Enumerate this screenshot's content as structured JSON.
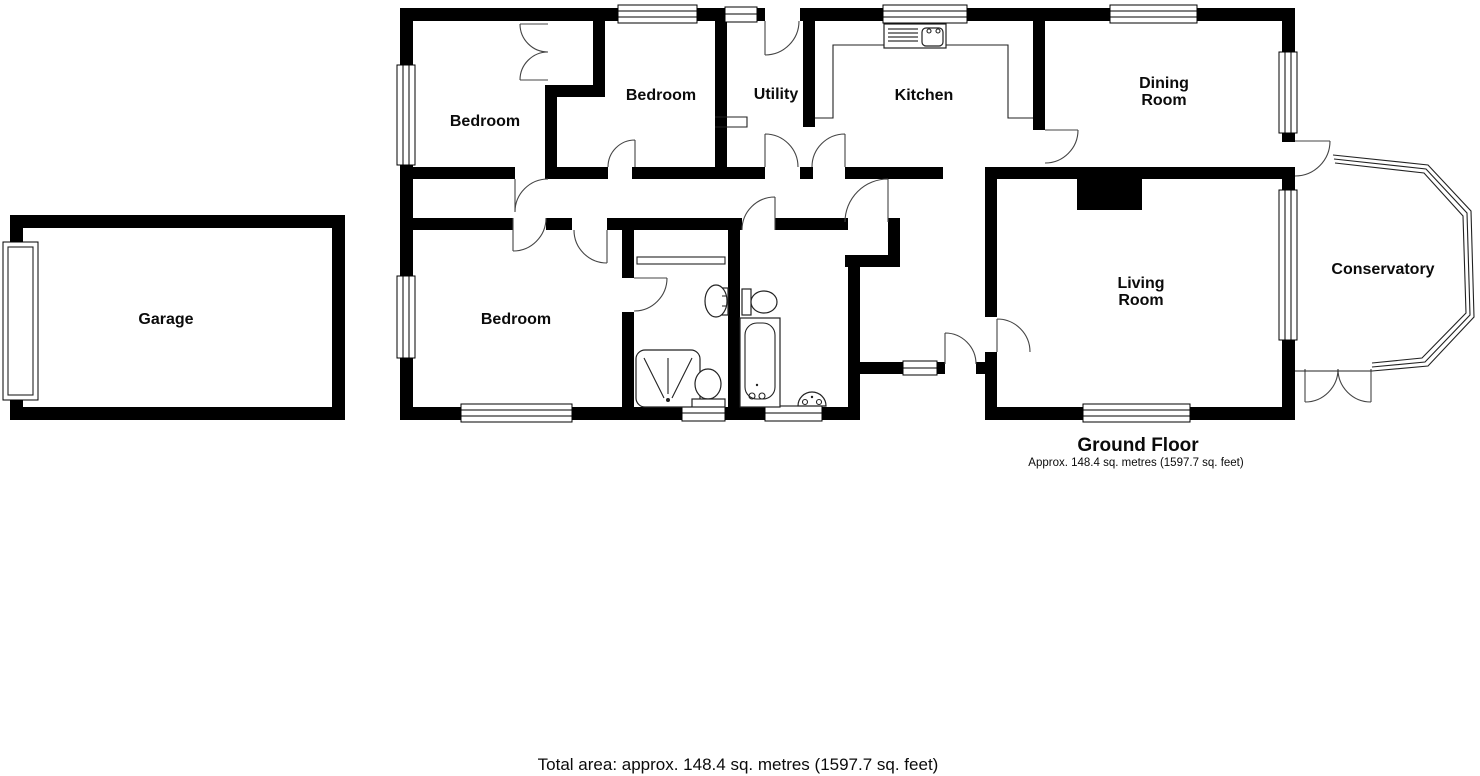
{
  "page": {
    "background": "#ffffff",
    "wall_color": "#000000",
    "door_arc_color": "#444444"
  },
  "floor": {
    "name": "Ground Floor",
    "area_note": "Approx. 148.4 sq. metres (1597.7 sq. feet)"
  },
  "footer": {
    "total_area": "Total area: approx. 148.4 sq. metres (1597.7 sq. feet)"
  },
  "rooms": {
    "garage": {
      "label": "Garage"
    },
    "bedroom1": {
      "label": "Bedroom"
    },
    "bedroom2": {
      "label": "Bedroom"
    },
    "bedroom3": {
      "label": "Bedroom"
    },
    "utility": {
      "label": "Utility"
    },
    "kitchen": {
      "label": "Kitchen"
    },
    "dining": {
      "label": "Dining Room",
      "line1": "Dining",
      "line2": "Room"
    },
    "living": {
      "label": "Living Room",
      "line1": "Living",
      "line2": "Room"
    },
    "conservatory": {
      "label": "Conservatory"
    }
  },
  "fixtures": {
    "kitchen_sink": "kitchen-sink-icon",
    "shower": "shower-icon",
    "shower_room_toilet": "toilet-icon",
    "shower_room_basin": "wash-basin-icon",
    "bath": "bath-icon",
    "bathroom_toilet": "toilet-icon",
    "bathroom_basin": "wash-basin-icon",
    "wardrobe": "wardrobe-double-doors-icon",
    "garage_door": "garage-door-icon",
    "front_door": "front-door-icon",
    "chimney_breast": "chimney-breast"
  }
}
